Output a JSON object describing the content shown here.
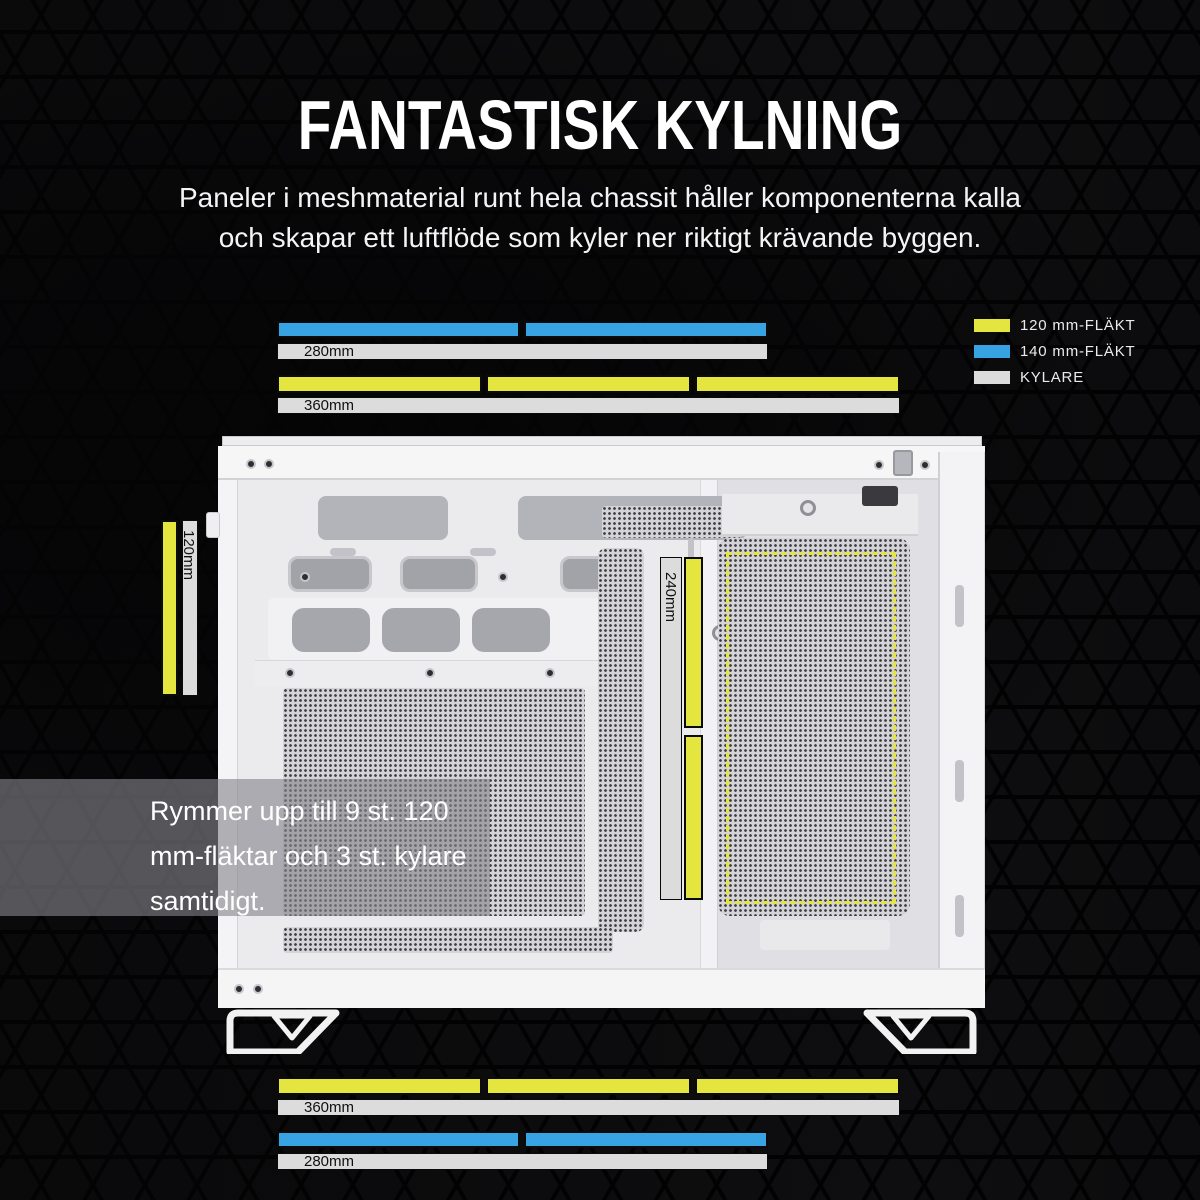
{
  "title": "FANTASTISK KYLNING",
  "subtitle": {
    "lines": [
      "Paneler i meshmaterial runt hela chassit håller komponenterna kalla",
      "och skapar ett luftflöde som kyler ner riktigt krävande byggen."
    ]
  },
  "colors": {
    "fan_120mm": "#e4e53f",
    "fan_140mm": "#38a3e2",
    "cooler": "#dcdcdc",
    "background": "#0a0a0b",
    "case_white": "#f4f4f6"
  },
  "legend": {
    "items": [
      {
        "label": "120 mm-FLÄKT",
        "color": "#e4e53f"
      },
      {
        "label": "140 mm-FLÄKT",
        "color": "#38a3e2"
      },
      {
        "label": "KYLARE",
        "color": "#dcdcdc"
      }
    ]
  },
  "measurements": {
    "top": {
      "fan140_segments": 2,
      "cooler_280_label": "280mm",
      "fan120_segments": 3,
      "cooler_360_label": "360mm"
    },
    "bottom": {
      "fan120_segments": 3,
      "cooler_360_label": "360mm",
      "fan140_segments": 2,
      "cooler_280_label": "280mm"
    },
    "left_side": {
      "fan120_segments": 1,
      "cooler_label": "120mm"
    },
    "internal": {
      "fan120_segments": 2,
      "cooler_label": "240mm"
    }
  },
  "callout": {
    "lines": [
      "Rymmer upp till 9 st. 120",
      "mm-fläktar och 3 st. kylare",
      "samtidigt."
    ]
  }
}
